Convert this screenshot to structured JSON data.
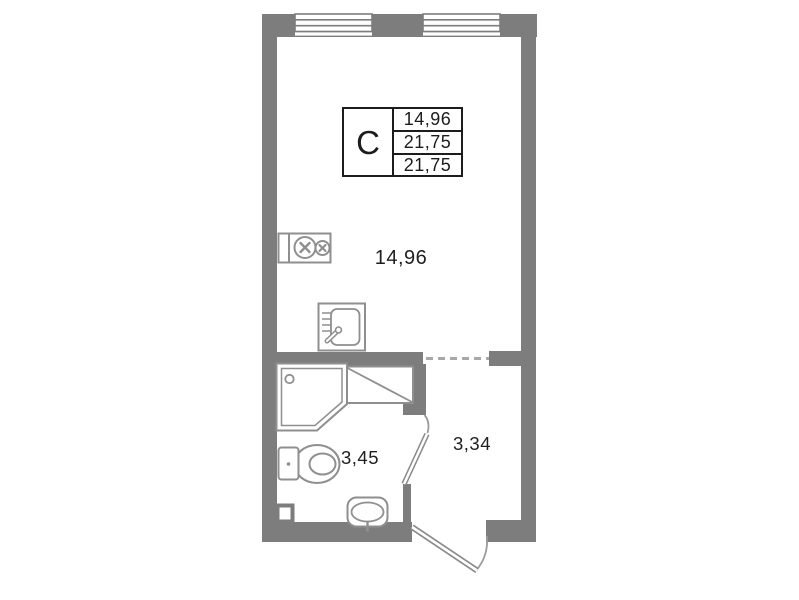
{
  "plan": {
    "info_table": {
      "type_label": "C",
      "rows": [
        "14,96",
        "21,75",
        "21,75"
      ]
    },
    "rooms": {
      "living": {
        "name": "living-room",
        "area": "14,96"
      },
      "bathroom": {
        "name": "bathroom",
        "area": "3,45"
      },
      "hallway": {
        "name": "hallway",
        "area": "3,34"
      }
    },
    "fixtures": [
      "stove-icon",
      "kitchen-sink-icon",
      "shower-cabin-icon",
      "toilet-icon",
      "washbasin-icon",
      "vent-niche-icon",
      "window-icon",
      "entry-door-icon",
      "bathroom-door-icon"
    ],
    "colors": {
      "wall": "#7d7d7d",
      "fixture_stroke": "#8f8f8f",
      "table_border": "#1c1c1c",
      "text": "#1f1f1f",
      "dashed_opening": "#a8a8a8",
      "background": "#ffffff"
    }
  }
}
